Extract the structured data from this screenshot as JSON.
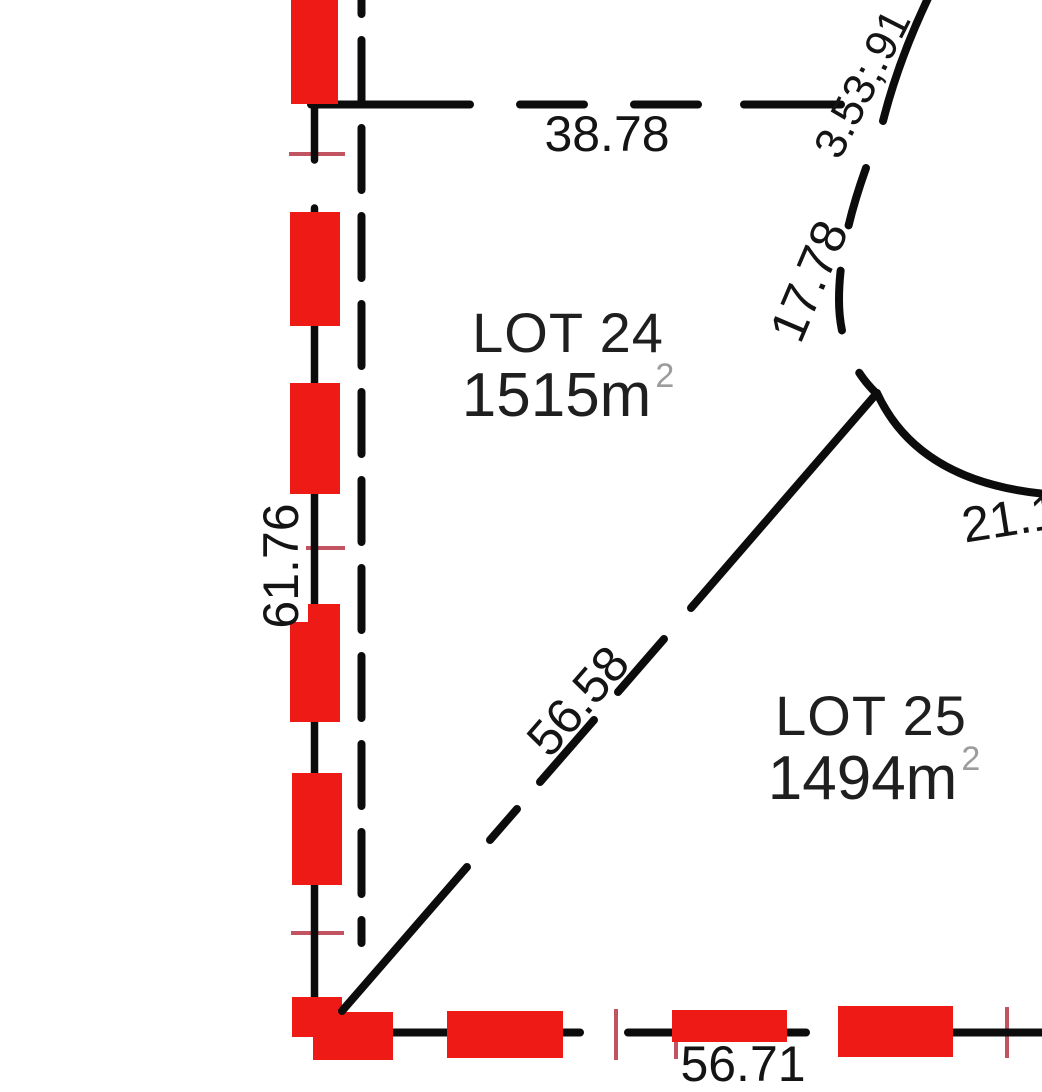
{
  "canvas": {
    "width": 1042,
    "height": 1080,
    "background": "#ffffff"
  },
  "colors": {
    "line": "#0c0c0c",
    "highlight": "#ee1a15",
    "tick": "#c25360",
    "dim_text": "#141414",
    "lot_text": "#1f1f1f",
    "sup": "#9c9c9c"
  },
  "lots": [
    {
      "name": "LOT 24",
      "area_value": "1515m",
      "area_exponent": "2"
    },
    {
      "name": "LOT 25",
      "area_value": "1494m",
      "area_exponent": "2"
    }
  ],
  "dimensions": {
    "top_boundary": "38.78",
    "left_boundary": "61.76",
    "diagonal_boundary": "56.58",
    "arc_upper": "3.53;.91",
    "arc_mid": "17.78",
    "arc_right": "21.18",
    "bottom_boundary": "56.71"
  }
}
